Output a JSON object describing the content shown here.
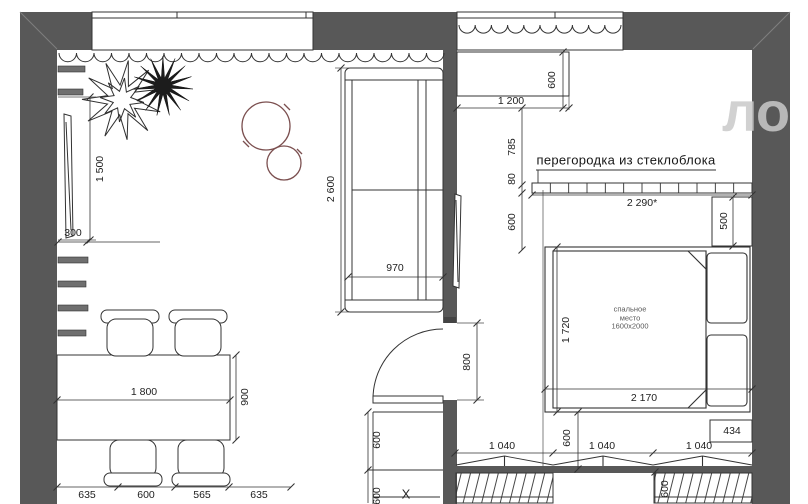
{
  "watermark": "ло",
  "labels": {
    "partition": "перегородка из стеклоблока",
    "bed": [
      "спальное",
      "место",
      "1600x2000"
    ],
    "x_mark": "X"
  },
  "dimensions": [
    {
      "text": "1 500",
      "x": 100,
      "y": 169,
      "rot": -90
    },
    {
      "text": "300",
      "x": 73,
      "y": 233,
      "rot": 0
    },
    {
      "text": "2 600",
      "x": 331,
      "y": 189,
      "rot": -90
    },
    {
      "text": "970",
      "x": 395,
      "y": 268,
      "rot": 0
    },
    {
      "text": "1 800",
      "x": 144,
      "y": 392,
      "rot": 0
    },
    {
      "text": "900",
      "x": 245,
      "y": 397,
      "rot": -90
    },
    {
      "text": "635",
      "x": 87,
      "y": 495,
      "rot": 0
    },
    {
      "text": "600",
      "x": 146,
      "y": 495,
      "rot": 0
    },
    {
      "text": "565",
      "x": 202,
      "y": 495,
      "rot": 0
    },
    {
      "text": "635",
      "x": 259,
      "y": 495,
      "rot": 0
    },
    {
      "text": "600",
      "x": 552,
      "y": 80,
      "rot": -90
    },
    {
      "text": "1 200",
      "x": 511,
      "y": 101,
      "rot": 0
    },
    {
      "text": "785",
      "x": 512,
      "y": 147,
      "rot": -90
    },
    {
      "text": "80",
      "x": 512,
      "y": 179,
      "rot": -90
    },
    {
      "text": "600",
      "x": 512,
      "y": 222,
      "rot": -90
    },
    {
      "text": "2 290*",
      "x": 642,
      "y": 203,
      "rot": 0
    },
    {
      "text": "500",
      "x": 724,
      "y": 221,
      "rot": -90
    },
    {
      "text": "800",
      "x": 467,
      "y": 362,
      "rot": -90
    },
    {
      "text": "1 720",
      "x": 566,
      "y": 330,
      "rot": -90
    },
    {
      "text": "2 170",
      "x": 644,
      "y": 398,
      "rot": 0
    },
    {
      "text": "434",
      "x": 732,
      "y": 431,
      "rot": 0
    },
    {
      "text": "1 040",
      "x": 502,
      "y": 446,
      "rot": 0
    },
    {
      "text": "1 040",
      "x": 602,
      "y": 446,
      "rot": 0
    },
    {
      "text": "1 040",
      "x": 699,
      "y": 446,
      "rot": 0
    },
    {
      "text": "600",
      "x": 567,
      "y": 438,
      "rot": -90
    },
    {
      "text": "600",
      "x": 377,
      "y": 440,
      "rot": -90
    },
    {
      "text": "600",
      "x": 377,
      "y": 496,
      "rot": -90
    },
    {
      "text": "600",
      "x": 665,
      "y": 489,
      "rot": -90
    }
  ],
  "colors": {
    "wall": "#585858",
    "line": "#333333",
    "pouf": "#7b4f4f",
    "watermark": "#c9c9c9",
    "background": "#ffffff"
  }
}
